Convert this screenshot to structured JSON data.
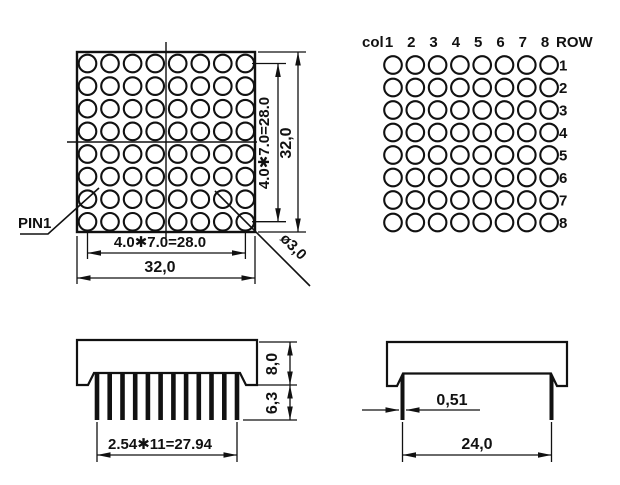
{
  "drawing": {
    "colors": {
      "line": "#111111",
      "background": "#ffffff"
    },
    "front_view": {
      "pin1_label": "PIN1",
      "dot_diameter_label": "ø3,0",
      "dim_h_pitch": "4.0✱7.0=28.0",
      "dim_h_overall": "32,0",
      "dim_v_pitch": "4.0✱7.0=28.0",
      "dim_v_overall": "32,0",
      "grid": {
        "rows": 8,
        "cols": 8
      }
    },
    "pinout_view": {
      "col_label": "col",
      "row_label": "ROW",
      "col_numbers": [
        "1",
        "2",
        "3",
        "4",
        "5",
        "6",
        "7",
        "8"
      ],
      "row_numbers": [
        "1",
        "2",
        "3",
        "4",
        "5",
        "6",
        "7",
        "8"
      ],
      "grid": {
        "rows": 8,
        "cols": 8
      }
    },
    "side_view_front": {
      "dim_body_height": "8,0",
      "dim_standoff": "6,3",
      "dim_pin_pitch": "2.54✱11=27.94",
      "pin_count": 12
    },
    "side_view_profile": {
      "dim_pin_thickness": "0,51",
      "dim_pin_row_spacing": "24,0",
      "pin_count": 2
    }
  }
}
